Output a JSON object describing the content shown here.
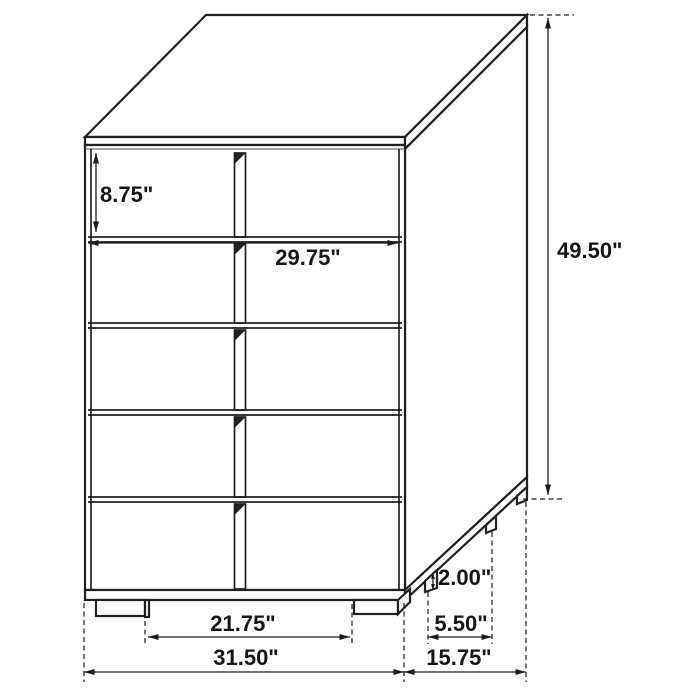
{
  "diagram": {
    "subject": "five-drawer chest isometric line drawing with dimension callouts",
    "units": "inches",
    "drawers_visible": 5,
    "dimensions": {
      "top_drawer_height": "8.75\"",
      "drawer_front_width": "29.75\"",
      "overall_height": "49.50\"",
      "leg_height": "2.00\"",
      "side_leg_spacing": "5.50\"",
      "front_leg_spacing": "21.75\"",
      "overall_width": "31.50\"",
      "overall_depth": "15.75\""
    },
    "colors": {
      "line": "#231f20",
      "background": "#ffffff",
      "text": "#161616"
    }
  }
}
